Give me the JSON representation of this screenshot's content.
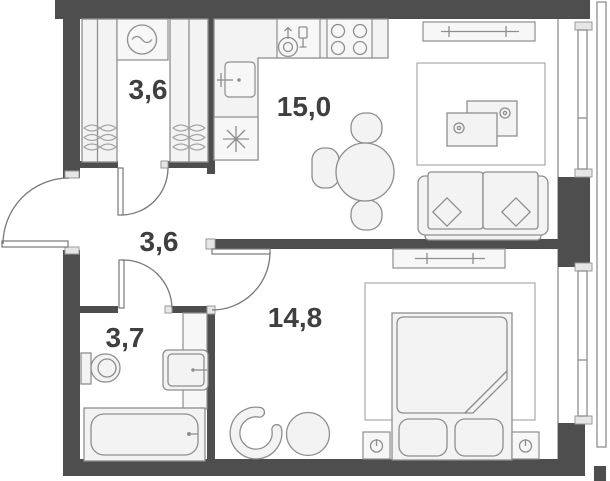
{
  "title": "One-room apartment floor plan",
  "rooms": [
    {
      "id": "dressing",
      "area": "3,6"
    },
    {
      "id": "kitchen-living",
      "area": "15,0"
    },
    {
      "id": "hallway",
      "area": "3,6"
    },
    {
      "id": "bathroom",
      "area": "3,7"
    },
    {
      "id": "bedroom",
      "area": "14,8"
    }
  ],
  "colors": {
    "wall": "#4e4e4e",
    "furniture_fill": "#f3f3f3",
    "furniture_stroke": "#8e8e8e",
    "label": "#3f3f3f",
    "background": "#ffffff"
  },
  "icons": [
    "washing-machine-icon",
    "wardrobe-basket-icon",
    "kitchen-sink-icon",
    "freezer-snowflake-icon",
    "dishwasher-icon",
    "stove-burners-icon",
    "dining-table-icon",
    "sofa-icon",
    "tv-table-icon",
    "sideboard-icon",
    "toilet-icon",
    "washbasin-icon",
    "bathtub-icon",
    "bed-icon",
    "nightstand-knob-icon",
    "armchair-icon",
    "pouf-icon",
    "door-swing-icon",
    "window-icon"
  ]
}
